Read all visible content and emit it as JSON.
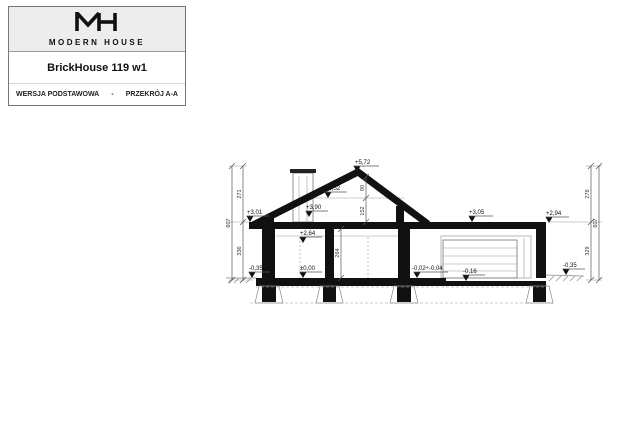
{
  "title_block": {
    "brand": "MODERN HOUSE",
    "project": "BrickHouse 119 w1",
    "version": "WERSJA PODSTAWOWA",
    "separator": "-",
    "view": "PRZEKRÓJ A-A"
  },
  "drawing": {
    "levels": {
      "ridge": "+5,72",
      "collar": "+4,52",
      "roof_at_chimney": "+3,90",
      "eave_left": "+3,01",
      "ceiling": "+2,64",
      "garage_roof": "+3,05",
      "garage_roof_edge": "+2,94",
      "floor": "±0,00",
      "grade_left": "-0,35",
      "garage_entry": "-0,02÷-0,04",
      "garage_floor": "-0,16",
      "grade_right": "-0,35"
    },
    "dimensions": {
      "left_upper": "271",
      "left_lower": "336",
      "left_total": "607",
      "right_upper": "278",
      "right_lower": "329",
      "right_total": "607",
      "room_height": "264",
      "attic_upper": "90",
      "attic_lower": "152"
    },
    "colors": {
      "line": "#111111",
      "dim": "#555555",
      "hatch": "#8a8a8a"
    }
  }
}
